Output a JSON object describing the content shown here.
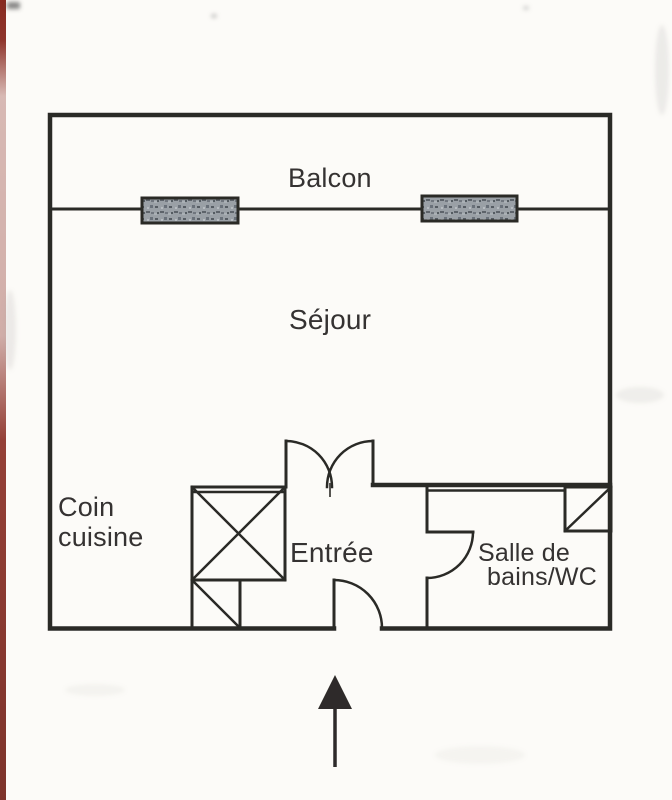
{
  "floor_plan": {
    "labels": {
      "balcony": "Balcon",
      "living_room": "Séjour",
      "kitchen_line1": "Coin",
      "kitchen_line2": "cuisine",
      "entrance": "Entrée",
      "bathroom_line1": "Salle de",
      "bathroom_line2": "bains/WC"
    },
    "symbols": {
      "window_count": 2,
      "entrance_arrow_direction": "up"
    },
    "colors": {
      "line": "#2b2a28",
      "text": "#343330",
      "paper": "#fcfbf8",
      "window_fill": "#9aa0a6",
      "page_edge_red": "#7f231a",
      "arrow": "#2d2c2a"
    }
  }
}
